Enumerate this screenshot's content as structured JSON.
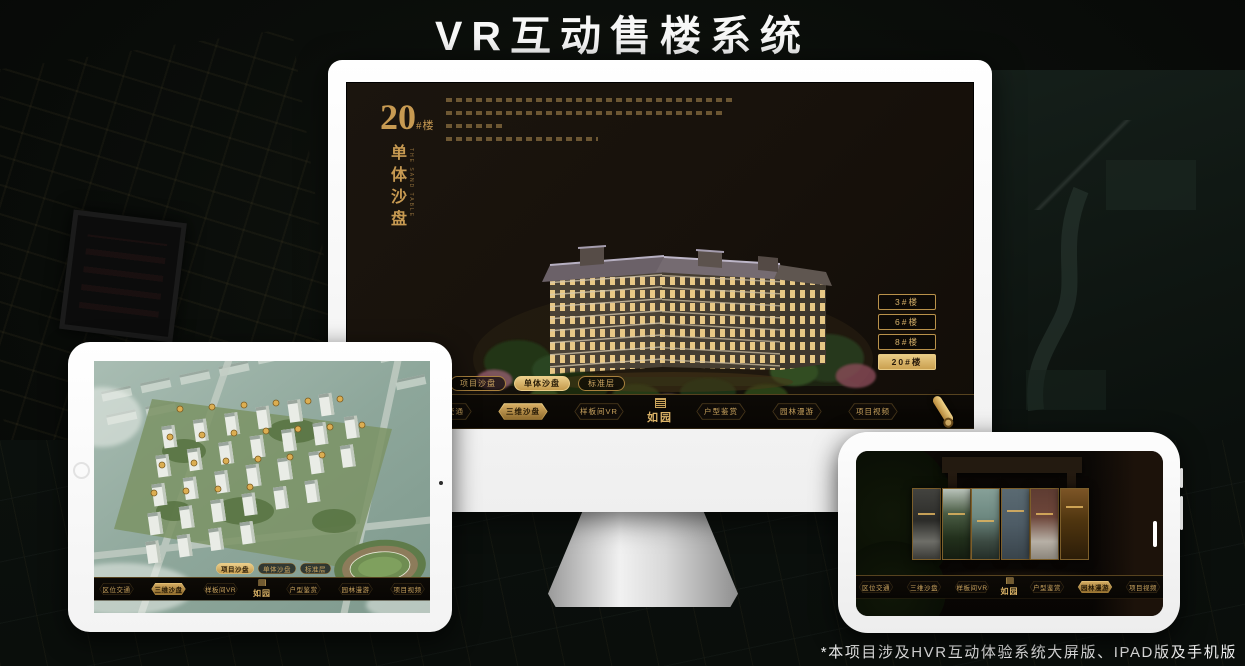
{
  "title": "VR互动售楼系统",
  "footnote": "*本项目涉及HVR互动体验系统大屏版、IPAD版及手机版",
  "brand": {
    "logo_text": "如园"
  },
  "colors": {
    "accent_gold": "#c9a35e",
    "accent_gold_bright": "#ecd08c",
    "screen_dark": "#17110b"
  },
  "desktop": {
    "headline": {
      "number": "20",
      "unit": "#楼",
      "title_vertical": "单体沙盘",
      "title_en": "THE SAND TABLE"
    },
    "floor_buttons": [
      {
        "label": "3#楼",
        "active": false
      },
      {
        "label": "6#楼",
        "active": false
      },
      {
        "label": "8#楼",
        "active": false
      },
      {
        "label": "20#楼",
        "active": true
      }
    ],
    "view_tabs": [
      {
        "label": "项目沙盘",
        "active": false
      },
      {
        "label": "单体沙盘",
        "active": true
      },
      {
        "label": "标准层",
        "active": false
      }
    ],
    "nav": {
      "items": [
        {
          "label": "区位交通",
          "active": false
        },
        {
          "label": "三维沙盘",
          "active": true
        },
        {
          "label": "样板间VR",
          "active": false
        },
        {
          "label": "户型鉴赏",
          "active": false
        },
        {
          "label": "园林漫游",
          "active": false
        },
        {
          "label": "项目视频",
          "active": false
        }
      ]
    }
  },
  "tablet": {
    "view_tabs": [
      {
        "label": "项目沙盘",
        "active": true
      },
      {
        "label": "单体沙盘",
        "active": false
      },
      {
        "label": "标准层",
        "active": false
      }
    ],
    "nav": {
      "items": [
        {
          "label": "区位交通",
          "active": false
        },
        {
          "label": "三维沙盘",
          "active": true
        },
        {
          "label": "样板间VR",
          "active": false
        },
        {
          "label": "户型鉴赏",
          "active": false
        },
        {
          "label": "园林漫游",
          "active": false
        },
        {
          "label": "项目视频",
          "active": false
        }
      ]
    }
  },
  "phone": {
    "nav": {
      "items": [
        {
          "label": "区位交通",
          "active": false
        },
        {
          "label": "三维沙盘",
          "active": false
        },
        {
          "label": "样板间VR",
          "active": false
        },
        {
          "label": "户型鉴赏",
          "active": false
        },
        {
          "label": "园林漫游",
          "active": true
        },
        {
          "label": "项目视频",
          "active": false
        }
      ]
    }
  }
}
